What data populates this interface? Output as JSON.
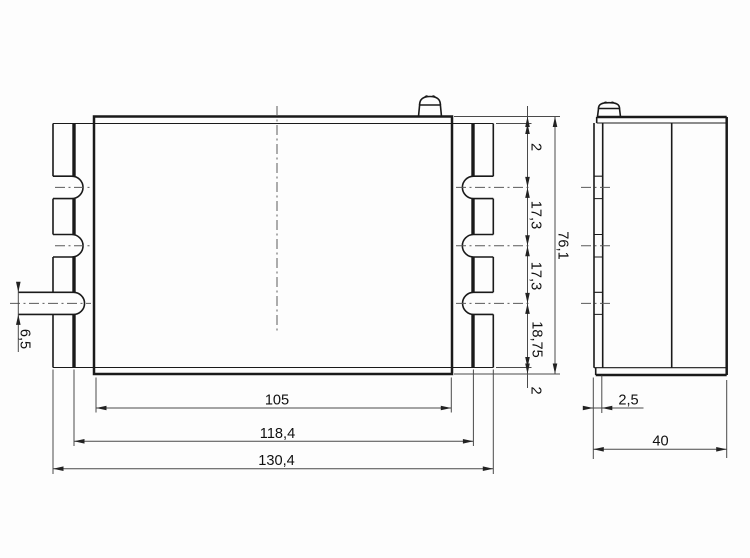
{
  "drawing": {
    "kind": "technical-dimension-drawing",
    "views": [
      "front",
      "side"
    ],
    "dimensions_mm": {
      "front": {
        "top_offset": 2,
        "slot_pitch_upper": 17.3,
        "slot_pitch_lower": 17.3,
        "slot_to_bottom": 18.75,
        "bottom_offset": 2,
        "overall_height": 76.1,
        "tongue_width": 6.5,
        "inner_width": 105,
        "plate_width": 118.4,
        "overall_width": 130.4
      },
      "side": {
        "plate_thickness": 2.5,
        "depth": 40
      }
    }
  },
  "labels": {
    "top_offset": "2",
    "slot_pitch_upper": "17,3",
    "slot_pitch_lower": "17,3",
    "slot_to_bottom": "18,75",
    "bottom_offset": "2",
    "overall_height": "76,1",
    "tongue_width": "6,5",
    "inner_width": "105",
    "plate_width": "118,4",
    "overall_width": "130,4",
    "plate_thickness": "2,5",
    "depth": "40"
  }
}
